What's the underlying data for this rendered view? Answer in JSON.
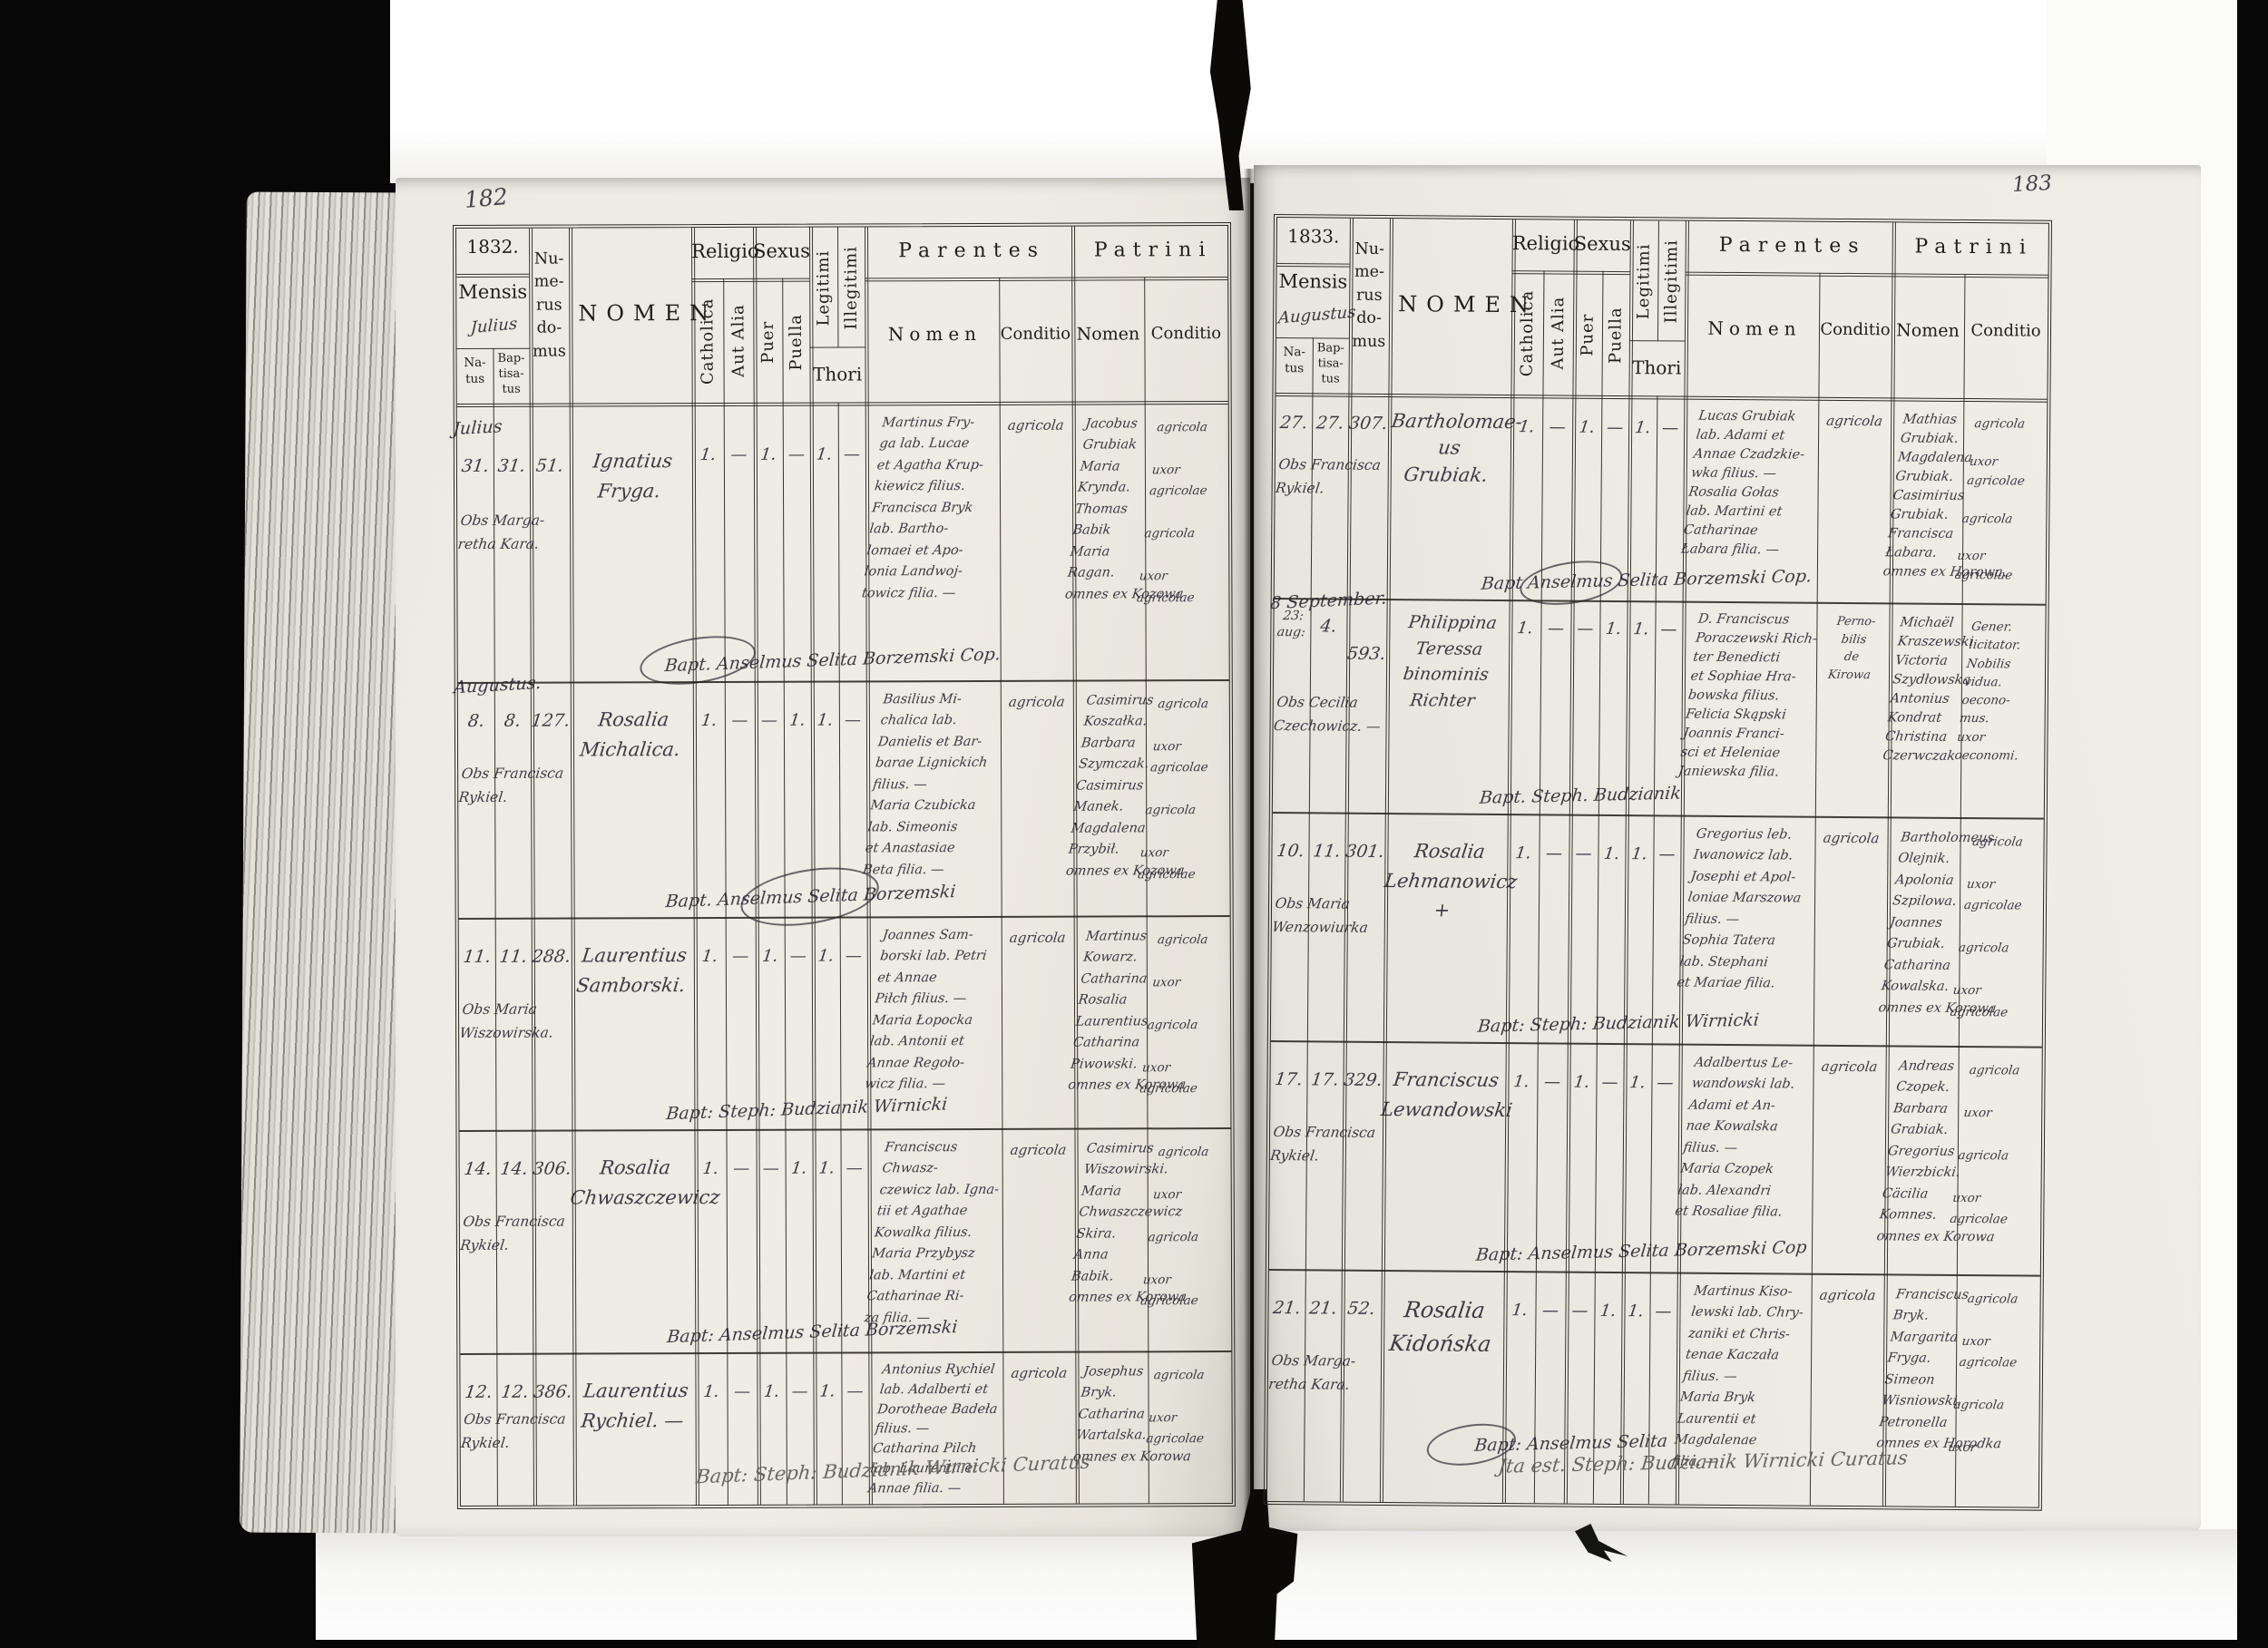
{
  "form": {
    "mensis": "Mensis",
    "natus": "Na-\ntus",
    "baptisatus": "Bap-\ntisa-\ntus",
    "numerus": "Nu-\nme-\nrus\ndo-\nmus",
    "nomen": "NOMEN",
    "religio": "Religio",
    "catholica": "Catholica",
    "aut_alia": "Aut Alia",
    "sexus": "Sexus",
    "puer": "Puer",
    "puella": "Puella",
    "legitimi": "Legitimi",
    "illegitimi": "Illegitimi",
    "thori": "Thori",
    "parentes": "Parentes",
    "patrini": "Patrini",
    "sub_nomen": "Nomen",
    "sub_conditio": "Conditio"
  },
  "page_left": {
    "page_number": "182",
    "year": "1832.",
    "mensis_value": "Julius",
    "bottom_note": "Bapt: Steph: Budzianik Wirnicki Curatus",
    "records": [
      {
        "mn": "Julius",
        "n": "31.",
        "b": "31.",
        "d": "51.",
        "obs": "Obs Marga-\nretha Kara.",
        "nom": "Ignatius\nFryga.",
        "cath": "1.",
        "alia": "—",
        "puer": "1.",
        "puella": "—",
        "leg": "1.",
        "illeg": "—",
        "par": "Martinus Fry-\nga lab. Lucae\net Agatha Krup-\nkiewicz filius.\nFrancisca Bryk\nlab. Bartho-\nlomaei et Apo-\nlonia Landwoj-\ntowicz filia. —",
        "parc": "agricola",
        "pat": "Jacobus\nGrubiak\nMaria\nKrynda.\nThomas\nBabik\nMaria\nRagan.\nomnes ex Kozowa",
        "patc": "agricola\n\nuxor\nagricolae\n\nagricola\n\nuxor\nagricolae",
        "foot": "Bapt. Anselmus Selita Borzemski Cop."
      },
      {
        "mn": "Augustus.",
        "n": "8.",
        "b": "8.",
        "d": "127.",
        "obs": "Obs Francisca\nRykiel.",
        "nom": "Rosalia\nMichalica.",
        "cath": "1.",
        "alia": "—",
        "puer": "—",
        "puella": "1.",
        "leg": "1.",
        "illeg": "—",
        "par": "Basilius Mi-\nchalica lab.\nDanielis et Bar-\nbarae Lignickich\nfilius. —\nMaria Czubicka\nlab. Simeonis\net Anastasiae\nBeta filia. —",
        "parc": "agricola",
        "pat": "Casimirus\nKoszałka.\nBarbara\nSzymczak.\nCasimirus\nManek.\nMagdalena\nPrzybił.\nomnes ex Kozowa",
        "patc": "agricola\n\nuxor\nagricolae\n\nagricola\n\nuxor\nagricolae",
        "foot": "Bapt. Anselmus Selita Borzemski"
      },
      {
        "mn": "",
        "n": "11.",
        "b": "11.",
        "d": "288.",
        "obs": "Obs Maria\nWiszowirska.",
        "nom": "Laurentius\nSamborski.",
        "cath": "1.",
        "alia": "—",
        "puer": "1.",
        "puella": "—",
        "leg": "1.",
        "illeg": "—",
        "par": "Joannes Sam-\nborski lab. Petri\net Annae\nPiłch filius. —\nMaria Łopocka\nlab. Antonii et\nAnnae Regoło-\nwicz filia. —",
        "parc": "agricola",
        "pat": "Martinus\nKowarz.\nCatharina\nRosalia\nLaurentius\nCatharina\nPiwowski.\nomnes ex Korowa",
        "patc": "agricola\n\nuxor\n\nagricola\n\nuxor\nagricolae",
        "foot": "Bapt: Steph: Budzianik Wirnicki"
      },
      {
        "mn": "",
        "n": "14.",
        "b": "14.",
        "d": "306.",
        "obs": "Obs Francisca\nRykiel.",
        "nom": "Rosalia\nChwaszczewicz",
        "cath": "1.",
        "alia": "—",
        "puer": "—",
        "puella": "1.",
        "leg": "1.",
        "illeg": "—",
        "par": "Franciscus Chwasz-\nczewicz lab. Igna-\ntii et Agathae\nKowalka filius.\nMaria Przybysz\nlab. Martini et\nCatharinae Ri-\nza filia. —",
        "parc": "agricola",
        "pat": "Casimirus\nWiszowirski.\nMaria\nChwaszczewicz\nSkira.\nAnna\nBabik.\nomnes ex Korowa",
        "patc": "agricola\n\nuxor\n\nagricola\n\nuxor\nagricolae",
        "foot": "Bapt: Anselmus Selita Borzemski"
      },
      {
        "mn": "",
        "n": "12.",
        "b": "12.",
        "d": "386.",
        "obs": "Obs Francisca\nRykiel.",
        "nom": "Laurentius\nRychiel. —",
        "cath": "1.",
        "alia": "—",
        "puer": "1.",
        "puella": "—",
        "leg": "1.",
        "illeg": "—",
        "par": "Antonius Rychiel\nlab. Adalberti et\nDorotheae Badeła\nfilius. —\nCatharina Pilch\nlab. Laurentii et\nAnnae filia. —",
        "parc": "agricola",
        "pat": "Josephus\nBryk.\nCatharina\nWartalska.\nomnes ex Korowa",
        "patc": "agricola\n\nuxor\nagricolae",
        "foot": ""
      }
    ]
  },
  "page_right": {
    "page_number": "183",
    "year": "1833.",
    "mensis_value": "Augustus",
    "bottom_note": "Jta est. Steph: Budzianik Wirnicki Curatus",
    "records": [
      {
        "mn": "",
        "n": "27.",
        "b": "27.",
        "d": "307.",
        "obs": "Obs Francisca\nRykiel.",
        "nom": "Bartholomae-\nus\nGrubiak.",
        "cath": "1.",
        "alia": "—",
        "puer": "1.",
        "puella": "—",
        "leg": "1.",
        "illeg": "—",
        "par": "Lucas Grubiak\nlab. Adami et\nAnnae Czadzkie-\nwka filius. —\nRosalia Gołas\nlab. Martini et\nCatharinae\nŁabara filia. —",
        "parc": "agricola",
        "pat": "Mathias\nGrubiak.\nMagdalena\nGrubiak.\nCasimirius\nGrubiak.\nFrancisca\nŁabara.\nomnes ex Horowa.",
        "patc": "agricola\n\nuxor\nagricolae\n\nagricola\n\nuxor\nagricolae",
        "foot": "Bapt Anselmus Selita Borzemski Cop."
      },
      {
        "mn": "8 September.",
        "n": "23:\naug:",
        "b": "4.",
        "d": "593.",
        "obs": "Obs Cecilia\nCzechowicz. —",
        "nom": "Philippina\nTeressa\nbinominis\nRichter",
        "cath": "1.",
        "alia": "—",
        "puer": "—",
        "puella": "1.",
        "leg": "1.",
        "illeg": "—",
        "par": "D. Franciscus\nPoraczewski Rich-\nter Benedicti\net Sophiae Hra-\nbowska filius.\nFelicia Skąpski\nJoannis Franci-\nsci et Heleniae\nJaniewska filia.",
        "parc": "Perno-\nbilis\nde\nKirowa",
        "pat": "Michaël\nKraszewski\nVictoria\nSzydłowska\nAntonius\nKondrat\nChristina\nCzerwczak",
        "patc": "Gener.\nlicitator.\nNobilis\nvidua.\noecono-\nmus.\nuxor\noeconomi.",
        "foot": "Bapt. Steph. Budzianik"
      },
      {
        "mn": "",
        "n": "10.",
        "b": "11.",
        "d": "301.",
        "obs": "Obs Maria\nWenzowiurka",
        "nom": "Rosalia\nLehmanowicz\n+",
        "cath": "1.",
        "alia": "—",
        "puer": "—",
        "puella": "1.",
        "leg": "1.",
        "illeg": "—",
        "par": "Gregorius leb.\nIwanowicz lab.\nJosephi et Apol-\nloniae Marszowa\nfilius. —\nSophia Tatera\nlab. Stephani\net Mariae filia.",
        "parc": "agricola",
        "pat": "Bartholomeus\nOlejnik.\nApolonia\nSzpilowa.\nJoannes\nGrubiak.\nCatharina\nKowalska.\nomnes ex Korowa",
        "patc": "agricola\n\nuxor\nagricolae\n\nagricola\n\nuxor\nagricolae",
        "foot": "Bapt: Steph: Budzianik Wirnicki"
      },
      {
        "mn": "",
        "n": "17.",
        "b": "17.",
        "d": "329.",
        "obs": "Obs Francisca\nRykiel.",
        "nom": "Franciscus\nLewandowski",
        "cath": "1.",
        "alia": "—",
        "puer": "1.",
        "puella": "—",
        "leg": "1.",
        "illeg": "—",
        "par": "Adalbertus Le-\nwandowski lab.\nAdami et An-\nnae Kowalska\nfilius. —\nMaria Czopek\nlab. Alexandri\net Rosaliae filia.",
        "parc": "agricola",
        "pat": "Andreas\nCzopek.\nBarbara\nGrabiak.\nGregorius\nWierzbicki.\nCäcilia\nKomnes.\nomnes ex Korowa",
        "patc": "agricola\n\nuxor\n\nagricola\n\nuxor\nagricolae",
        "foot": "Bapt: Anselmus Selita Borzemski Cop"
      },
      {
        "mn": "",
        "n": "21.",
        "b": "21.",
        "d": "52.",
        "obs": "Obs Marga-\nretha Kara.",
        "nom": "Rosalia\nKidońska",
        "cath": "1.",
        "alia": "—",
        "puer": "—",
        "puella": "1.",
        "leg": "1.",
        "illeg": "—",
        "par": "Martinus Kiso-\nlewski lab. Chry-\nzaniki et Chris-\ntenae Kaczała\nfilius. —\nMaria Bryk\nLaurentii et\nMagdalenae\nfilia. —",
        "parc": "agricola",
        "pat": "Franciscus\nBryk.\nMargarita\nFryga.\nSimeon\nWisniowski.\nPetronella\nomnes ex Horodka",
        "patc": "agricola\n\nuxor\nagricolae\n\nagricola\n\nuxor",
        "foot": "Bapt: Anselmus Selita"
      }
    ]
  }
}
